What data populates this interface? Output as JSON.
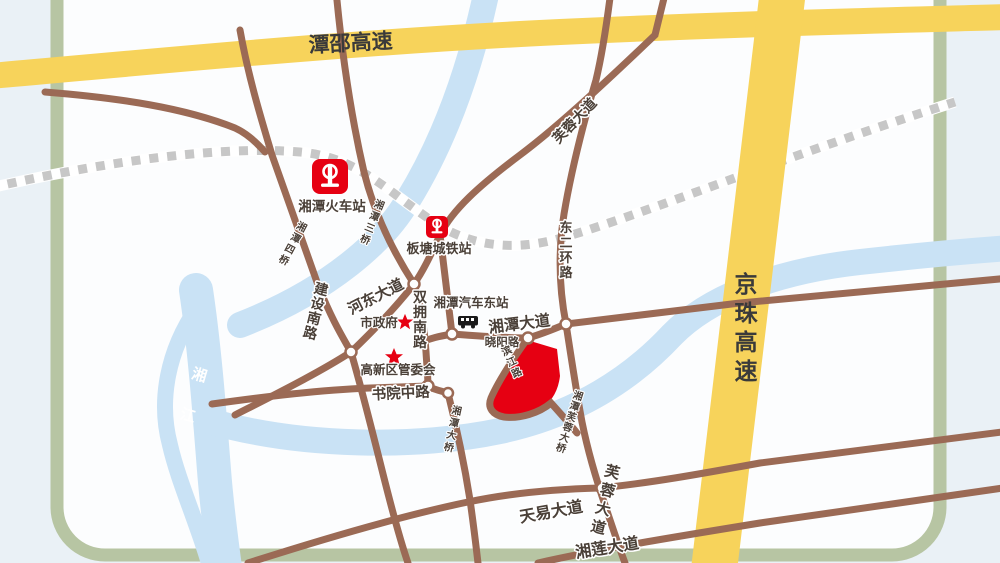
{
  "labels": {
    "tanshao_expwy": "潭邵高速",
    "jingzhu_expwy": "京珠高速",
    "railway_station": "湘潭火车站",
    "bantang_station": "板塘城铁站",
    "bus_station": "湘潭汽车东站",
    "xiangtan_ave": "湘潭大道",
    "xiaoyang_rd": "晓阳路",
    "hedong_ave": "河东大道",
    "shuangyong_rd": "双拥南路",
    "jianshe_rd": "建设南路",
    "shuyuan_rd": "书院中路",
    "dongerhuan_rd": "东二环路",
    "furong_ave_n": "芙蓉大道",
    "furong_ave_s": "芙蓉大道",
    "tianyi_ave": "天易大道",
    "xianglian_ave": "湘莲大道",
    "binjiang_rd": "滨江路",
    "city_gov": "市政府",
    "hitech_committee": "高新区管委会",
    "sanqiao_bridge": "湘潭三桥",
    "siqiao_bridge": "湘潭四桥",
    "daqiao_bridge": "湘潭大桥",
    "furong_bridge": "湘潭芙蓉大桥",
    "river": "湘江"
  },
  "colors": {
    "expressway": "#f7d35b",
    "road": "#9b6a55",
    "railway": "#c7c7c7",
    "river": "#c9e2f5",
    "highlight": "#e60012",
    "marker": "#e60012",
    "border": "#b7c5a3",
    "background": "#fcfdfe"
  }
}
